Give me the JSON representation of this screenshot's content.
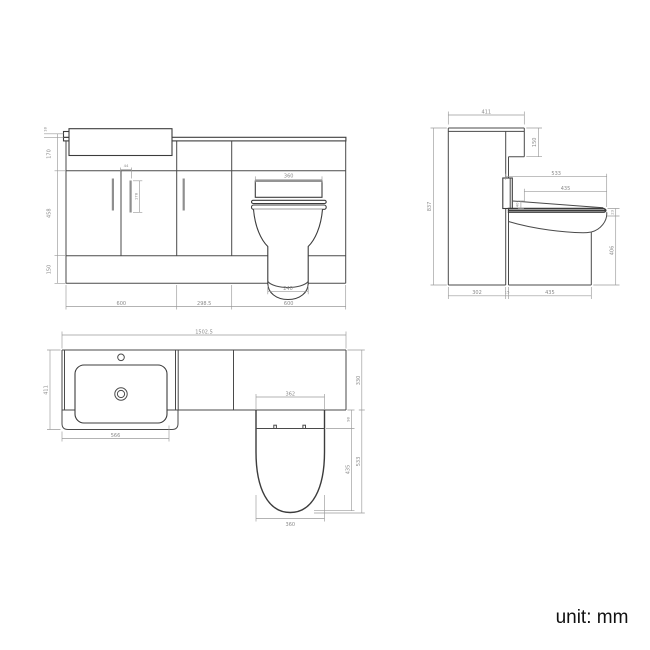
{
  "unit_label": "unit: mm",
  "colors": {
    "object_line": "#4a4a4a",
    "dimension_line": "#9a9a9a",
    "background": "#ffffff"
  },
  "views": {
    "front": {
      "name": "front-elevation",
      "dims": {
        "thickness18": "18",
        "height170": "170",
        "height458": "458",
        "height150": "150",
        "width600_left": "600",
        "width298": "298.5",
        "width600_right": "600",
        "flap360": "360",
        "base240": "240",
        "handle44": "44",
        "handle178": "178"
      }
    },
    "side": {
      "name": "side-elevation",
      "dims": {
        "depth411": "411",
        "drop150": "150",
        "height837": "837",
        "seat533": "533",
        "seat435": "435",
        "wedge40": "40",
        "lip23": "23",
        "pan406": "406",
        "base302": "302",
        "gap15": "15",
        "pan435": "435"
      }
    },
    "plan": {
      "name": "plan-view",
      "dims": {
        "total1502": "1502.5",
        "depth411": "411",
        "basin566": "566",
        "seat362": "362",
        "band330": "330",
        "hinge98": "98",
        "seat435": "435",
        "pan533": "533",
        "front360": "360"
      }
    }
  }
}
